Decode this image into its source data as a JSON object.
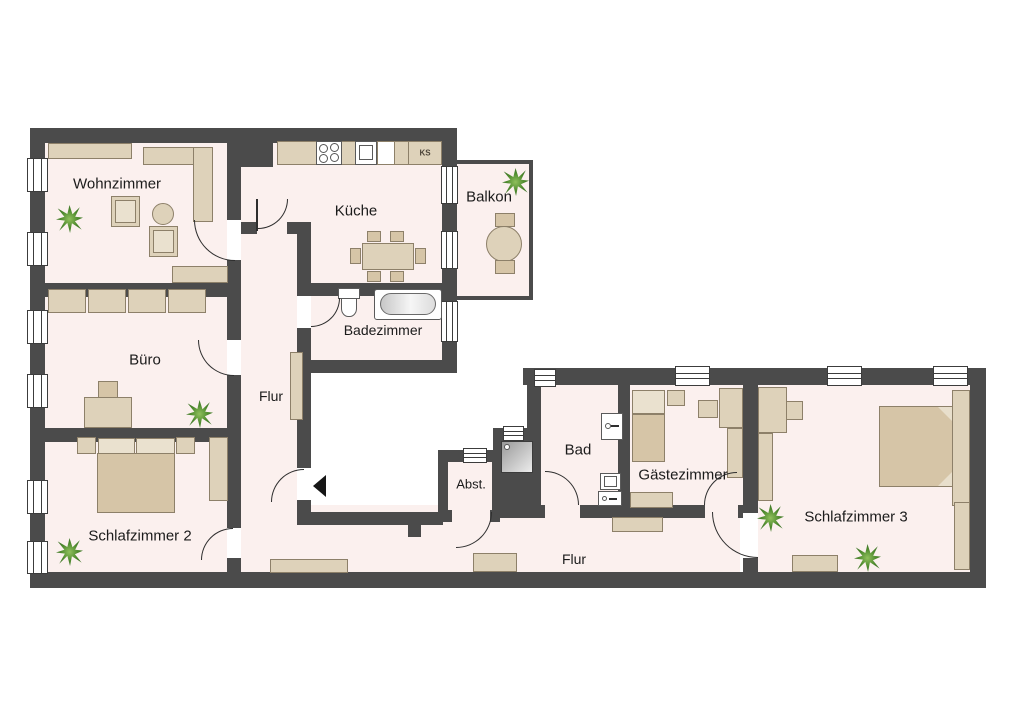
{
  "floorplan": {
    "rooms": {
      "wohnzimmer": {
        "label": "Wohnzimmer"
      },
      "kueche": {
        "label": "Küche"
      },
      "balkon": {
        "label": "Balkon"
      },
      "badezimmer": {
        "label": "Badezimmer"
      },
      "buero": {
        "label": "Büro"
      },
      "flur": {
        "label": "Flur"
      },
      "schlafzimmer2": {
        "label": "Schlafzimmer 2"
      },
      "abstellraum": {
        "label": "Abst."
      },
      "bad": {
        "label": "Bad"
      },
      "gaestezimmer": {
        "label": "Gästezimmer"
      },
      "flur2": {
        "label": "Flur"
      },
      "schlafzimmer3": {
        "label": "Schlafzimmer 3"
      },
      "kuehlschrank_abbr": {
        "label": "KS"
      }
    },
    "colors": {
      "wall": "#4b4b4b",
      "floor": "#fbf0ee",
      "furniture": "#ded2ba",
      "furniture_dark": "#d6c5a7",
      "plant_green": "#4e8a2e",
      "background": "#ffffff"
    }
  }
}
